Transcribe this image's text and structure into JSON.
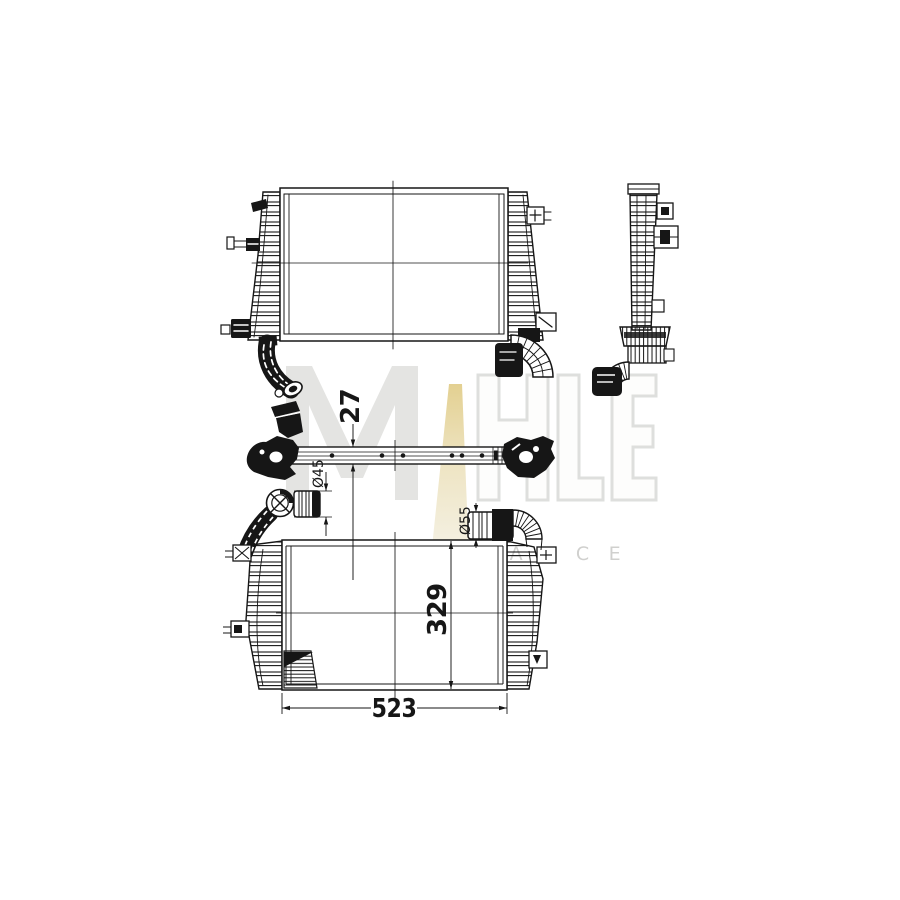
{
  "watermark": {
    "brand": "MAHLE",
    "letters": [
      "M",
      "A",
      "H",
      "L",
      "E"
    ],
    "tagline": "PERFORMANCE",
    "gray": "#e4e4e2",
    "outline_gray": "#dedfdd",
    "tagline_color": "#d0d0ce",
    "gold_top": "#e3d091",
    "gold_bottom": "#f5f2e6"
  },
  "dimensions": {
    "plan_thickness": "27",
    "inlet_diameter": "Ø45",
    "outlet_diameter": "Ø55",
    "core_height": "329",
    "core_width": "523"
  },
  "colors": {
    "line": "#161616",
    "background": "#ffffff"
  }
}
